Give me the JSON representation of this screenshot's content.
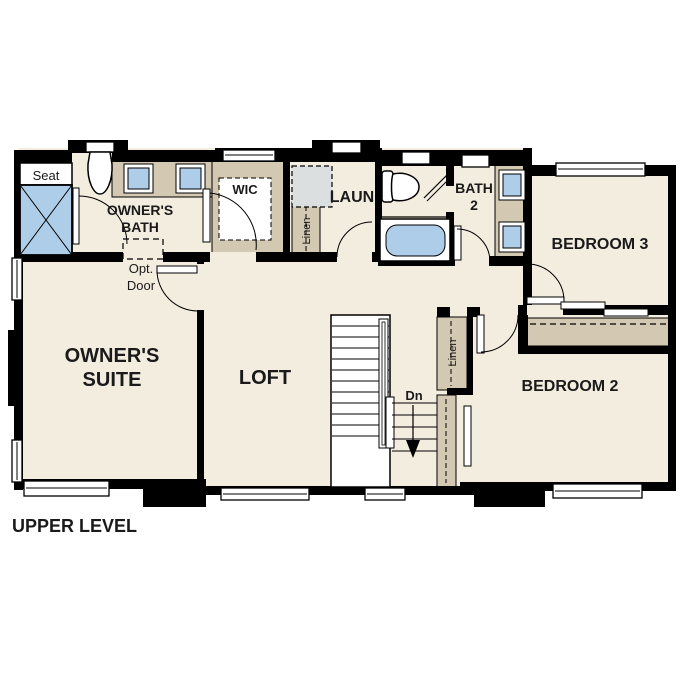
{
  "title": "UPPER LEVEL",
  "colors": {
    "wall": "#000000",
    "floor": "#f3ede0",
    "counter_tan": "#d3c8b1",
    "fixture_blue": "#aecde8",
    "appliance_gray": "#dcdfdf",
    "background": "#ffffff"
  },
  "rooms": {
    "owners_suite": {
      "line1": "OWNER'S",
      "line2": "SUITE"
    },
    "owners_bath": {
      "line1": "OWNER'S",
      "line2": "BATH"
    },
    "wic": {
      "label": "WIC"
    },
    "laundry": {
      "label": "LAUN"
    },
    "bath2": {
      "line1": "BATH",
      "line2": "2"
    },
    "bedroom3": {
      "label": "BEDROOM 3"
    },
    "bedroom2": {
      "label": "BEDROOM 2"
    },
    "loft": {
      "label": "LOFT"
    }
  },
  "annotations": {
    "seat": "Seat",
    "opt_door": {
      "line1": "Opt.",
      "line2": "Door"
    },
    "linen_upper": "Linen",
    "linen_hall": "Linen",
    "stairs_down": "Dn"
  }
}
